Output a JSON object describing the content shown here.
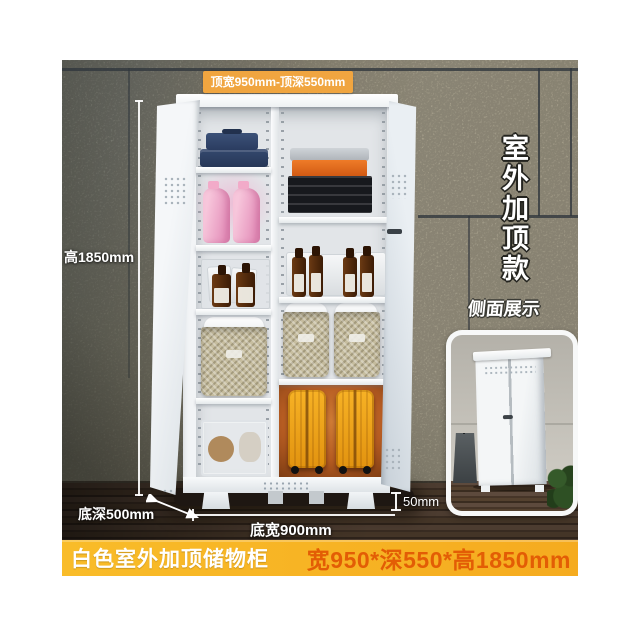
{
  "annotations": {
    "top_dimension": "顶宽950mm-顶深550mm",
    "height_dimension": "高1850mm",
    "base_depth": "底深500mm",
    "base_width": "底宽900mm",
    "leg_height": "50mm",
    "corner_tag_vertical": "室外加顶款",
    "side_view_label": "侧面展示"
  },
  "banner": {
    "product_name": "白色室外加顶储物柜",
    "size_text": "宽950*深550*高1850mm"
  },
  "colors": {
    "banner_bg": "#f5ab1f",
    "banner_name_text": "#ffffff",
    "banner_size_text": "#e35d05",
    "dimension_label_bg": "#f0a540",
    "annotation_text": "#ffffff"
  }
}
